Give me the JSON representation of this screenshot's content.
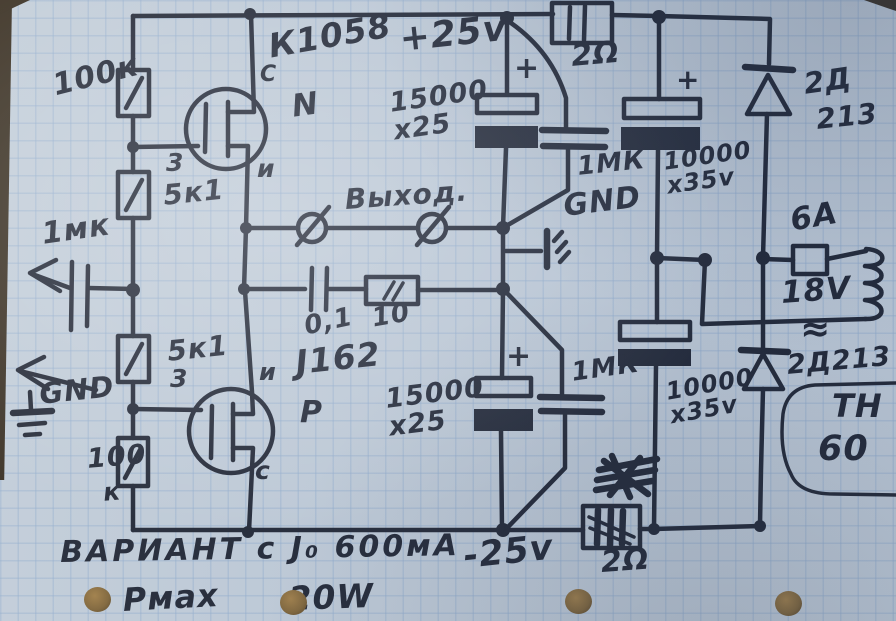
{
  "meta": {
    "title": "Hand-drawn MOSFET amplifier schematic (К1058 / J162, ±25V) on graph paper"
  },
  "colors": {
    "ink": "#1a2030",
    "paper": "#c2ceDC",
    "grid": "#8facd066",
    "hole": "#7d6134",
    "shadowedge": "#32281c"
  },
  "labels": {
    "r100k_top": "100к",
    "r5k1_top": "5к1",
    "c1mk_in": "1мк",
    "gnd_in": "GND",
    "r5k1_bot": "5к1",
    "r100k_bot": "100",
    "r100k_bot_unit": "к",
    "q1": "К1058",
    "q1_type": "N",
    "q1_drain": "С",
    "q1_gate": "3",
    "q1_source": "и",
    "q2": "J162",
    "q2_type": "P",
    "q2_gate": "3",
    "q2_source": "и",
    "q2_drain": "с",
    "vplus": "+25v",
    "vminus": "-25v",
    "c15000_top": "15000\nх25",
    "c15000_top_plus": "+",
    "c15000_bot": "15000\nх25",
    "c15000_bot_plus": "+",
    "r2ohm_top": "2Ω",
    "r2ohm_bot": "2Ω",
    "c1mk_top": "1МК",
    "c1mk_bot": "1МК",
    "gnd_mid": "GND",
    "c10000_top": "10000\nх35v",
    "c10000_top_plus": "+",
    "c10000_bot": "10000\nх35v",
    "d1_line1": "2Д",
    "d1_line2": "213",
    "fuse": "6А",
    "v18": "18V",
    "ac_tilde": "≈",
    "d2": "2Д213",
    "tr_line1": "ТН",
    "tr_line2": "60",
    "zobel_c": "0,1",
    "zobel_r": "10",
    "output": "Выход.",
    "caption1": "ВАРИАНТ с J₀ 600мА",
    "caption2": "Рмах",
    "caption3": "20W"
  }
}
